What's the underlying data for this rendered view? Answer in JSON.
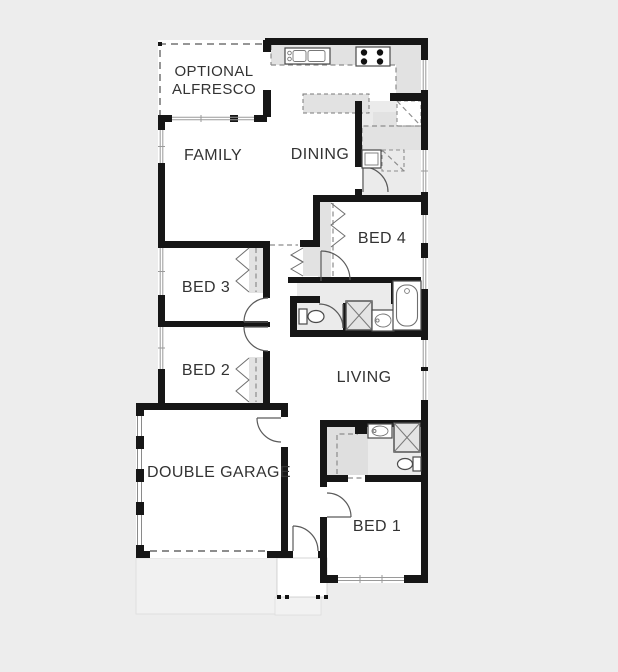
{
  "page": {
    "kind": "residential single-storey floor plan",
    "background": "#ededed"
  },
  "palette": {
    "wall": "#161616",
    "room_fill": "#ffffff",
    "fixture_fill": "#e2e2e2",
    "wet_area_fill": "#ebebeb",
    "slab_fill": "#f1f1f1",
    "dashed_line": "#8c8c8c",
    "door_line": "#5a5a5a",
    "label_color": "#333333"
  },
  "labels": {
    "alfresco_line1": "OPTIONAL",
    "alfresco_line2": "ALFRESCO",
    "family": "FAMILY",
    "dining": "DINING",
    "bed4": "BED 4",
    "bed3": "BED 3",
    "bed2": "BED 2",
    "living": "LIVING",
    "garage": "DOUBLE GARAGE",
    "bed1": "BED 1"
  },
  "fixtures": {
    "kitchen_sink": "double-bowl sink with taps",
    "cooktop": "4-burner cooktop",
    "island_bench": "kitchen island bench",
    "corner_pantry": "corner pantry (dashed)",
    "laundry_tub": "laundry tub",
    "washer_space": "washing machine space (dashed)",
    "bathtub": "bathtub",
    "shower_main": "shower with X",
    "shower_ensuite": "shower with X",
    "toilet_wc": "toilet",
    "toilet_ensuite": "toilet",
    "vanity_main": "vanity basin",
    "vanity_ensuite": "vanity basin",
    "wardrobe_bed2": "bifold robe",
    "wardrobe_bed3": "bifold robe",
    "wardrobe_bed4": "bifold robe",
    "linen_cupboard": "linen bifold cupboard",
    "walk_in_robe": "walk-in robe (dashed)",
    "garage_door": "dashed garage panel-lift door",
    "porch_pillars": "4 porch pillar dots",
    "sliding_door": "family sliding door",
    "windows": "double-line wall windows"
  }
}
